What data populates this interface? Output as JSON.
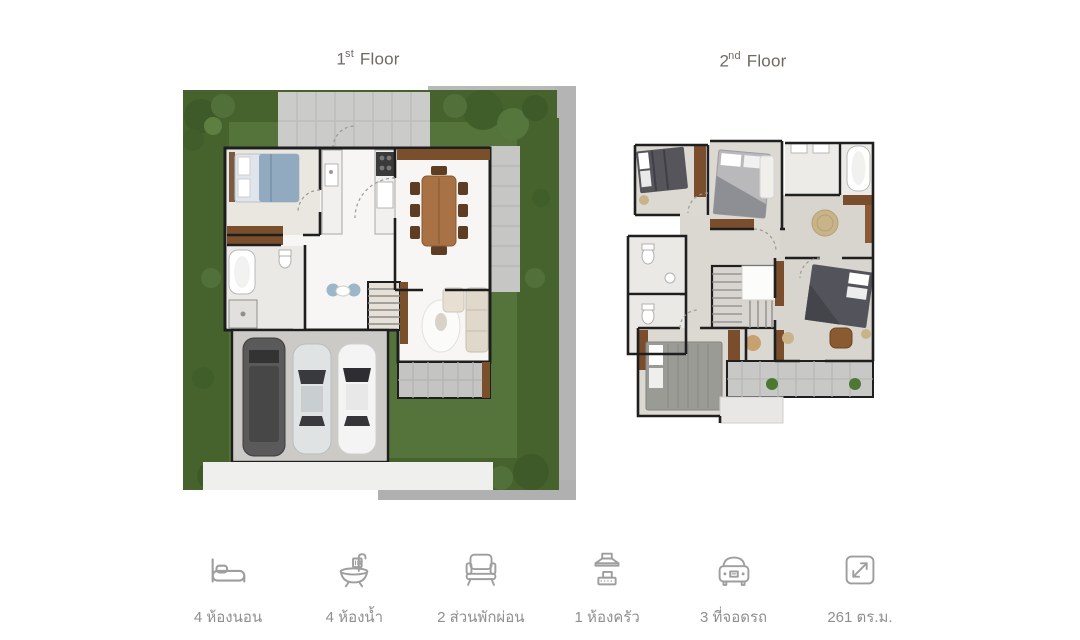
{
  "floors": {
    "first": {
      "num": "1",
      "suffix": "st",
      "word": "Floor"
    },
    "second": {
      "num": "2",
      "suffix": "nd",
      "word": "Floor"
    }
  },
  "features": [
    {
      "icon": "bed-icon",
      "label": "4 ห้องนอน"
    },
    {
      "icon": "bath-icon",
      "label": "4 ห้องน้ำ"
    },
    {
      "icon": "sofa-icon",
      "label": "2 ส่วนพักผ่อน"
    },
    {
      "icon": "kitchen-hood-icon",
      "label": "1 ห้องครัว"
    },
    {
      "icon": "car-icon",
      "label": "3 ที่จอดรถ"
    },
    {
      "icon": "area-icon",
      "label": "261 ตร.ม."
    }
  ],
  "colors": {
    "hedge": "#46632e",
    "lawn": "#55743c",
    "path_gray": "#b8b8b8",
    "concrete": "#cccac6",
    "wall": "#1e1e1e",
    "wood": "#7a4f2c",
    "floor_white": "#f7f6f4",
    "floor_greige": "#dcd8d2",
    "icon_gray": "#9e9e9e",
    "label_gray": "#8f8f8f",
    "title_gray": "#6f6962"
  }
}
